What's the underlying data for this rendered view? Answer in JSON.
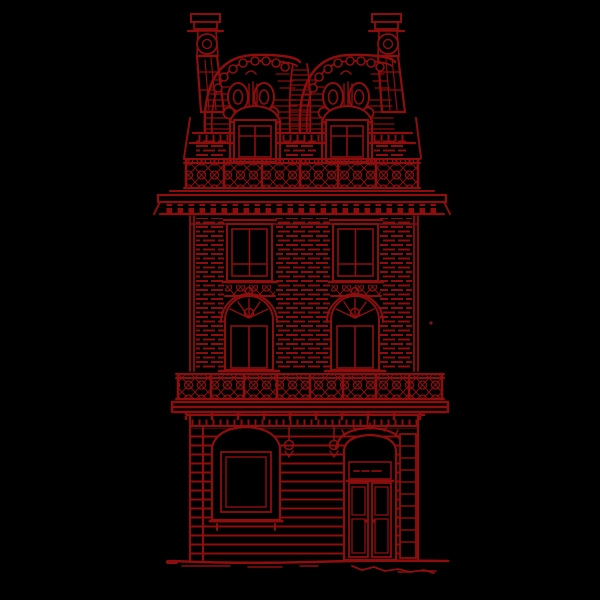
{
  "canvas": {
    "width": 600,
    "height": 600
  },
  "colors": {
    "background": "#000000",
    "ink": "#8e0e0e"
  },
  "illustration": {
    "name": "parisian-building-line-engraving",
    "alt": "Dark red line engraving of an ornate twin-domed Parisian building facade on a black background",
    "parts": [
      "chimney-left",
      "chimney-right",
      "double-dome-mansard-roof",
      "roof-valley",
      "attic-dormer-windows",
      "attic-balcony-railing",
      "main-cornice",
      "third-floor-windows",
      "second-floor-arched-windows",
      "second-floor-balcony",
      "ground-floor-rustication",
      "shop-window",
      "lamp-brackets",
      "entrance-door",
      "door-sidelight",
      "ground-line"
    ]
  }
}
